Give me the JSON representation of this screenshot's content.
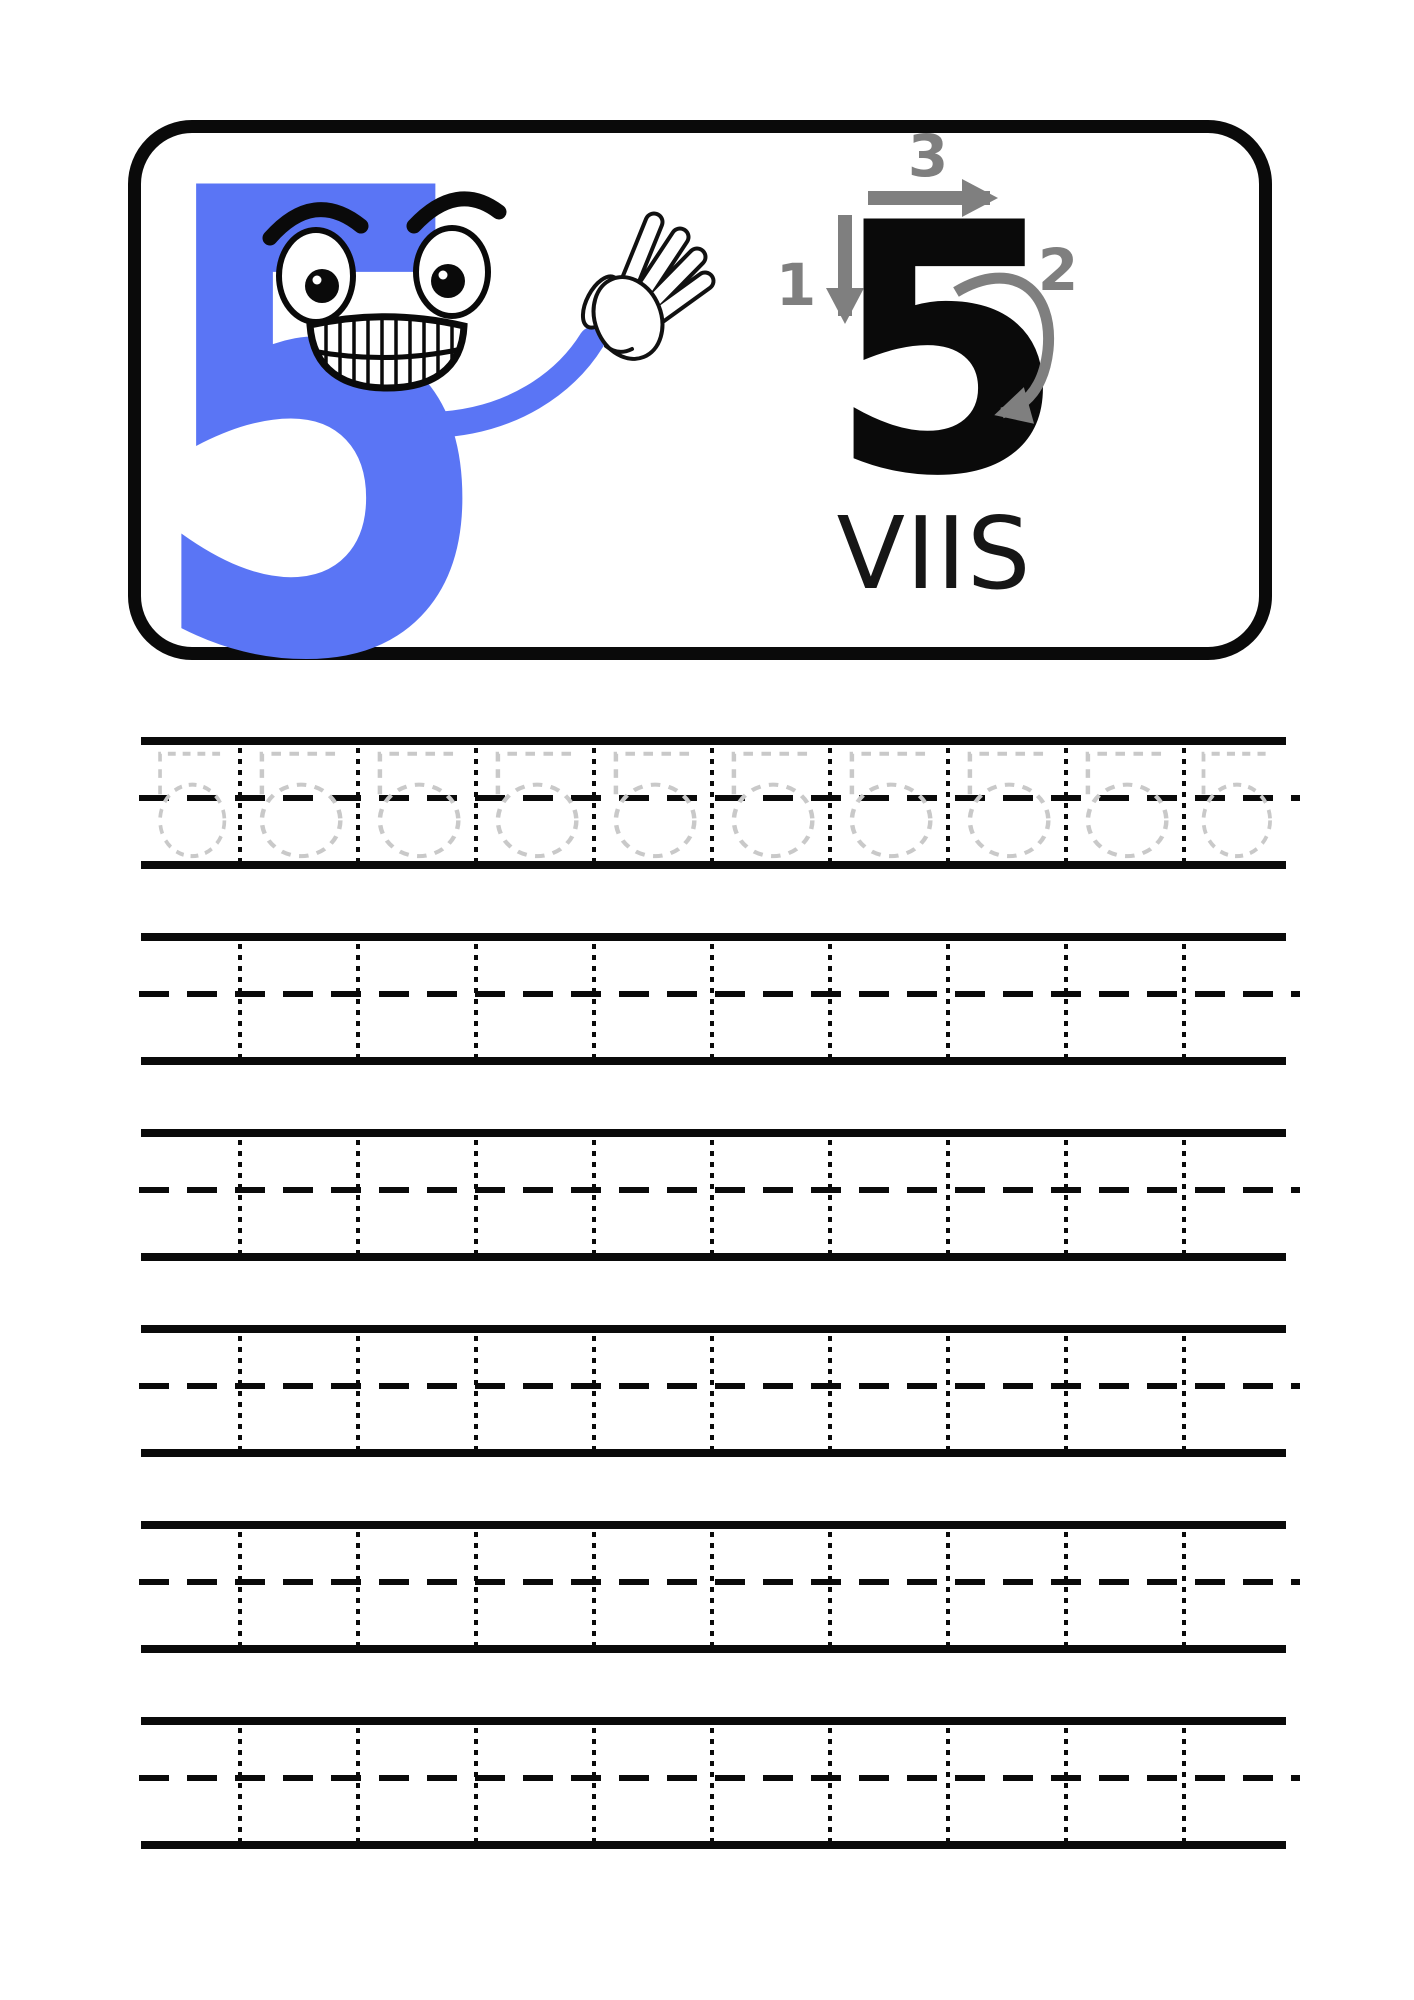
{
  "page": {
    "background": "#ffffff"
  },
  "header_card": {
    "border_color": "#0a0a0a",
    "mascot": {
      "digit": "5",
      "color": "#5a75f5",
      "name": "smiling-number-five-waving-hand"
    },
    "stroke_guide": {
      "digit": "5",
      "digit_color": "#0a0a0a",
      "arrow_color": "#7f7f7f",
      "steps": [
        {
          "label": "1",
          "direction": "down"
        },
        {
          "label": "2",
          "direction": "curve-down-right"
        },
        {
          "label": "3",
          "direction": "right"
        }
      ]
    },
    "word": "VIIS"
  },
  "tracing": {
    "trace_digit": "5",
    "trace_color": "#c9c9c9",
    "grid_line_color": "#0a0a0a",
    "rows_total": 6,
    "traced_row_index": 0,
    "cells_per_row": 10
  }
}
